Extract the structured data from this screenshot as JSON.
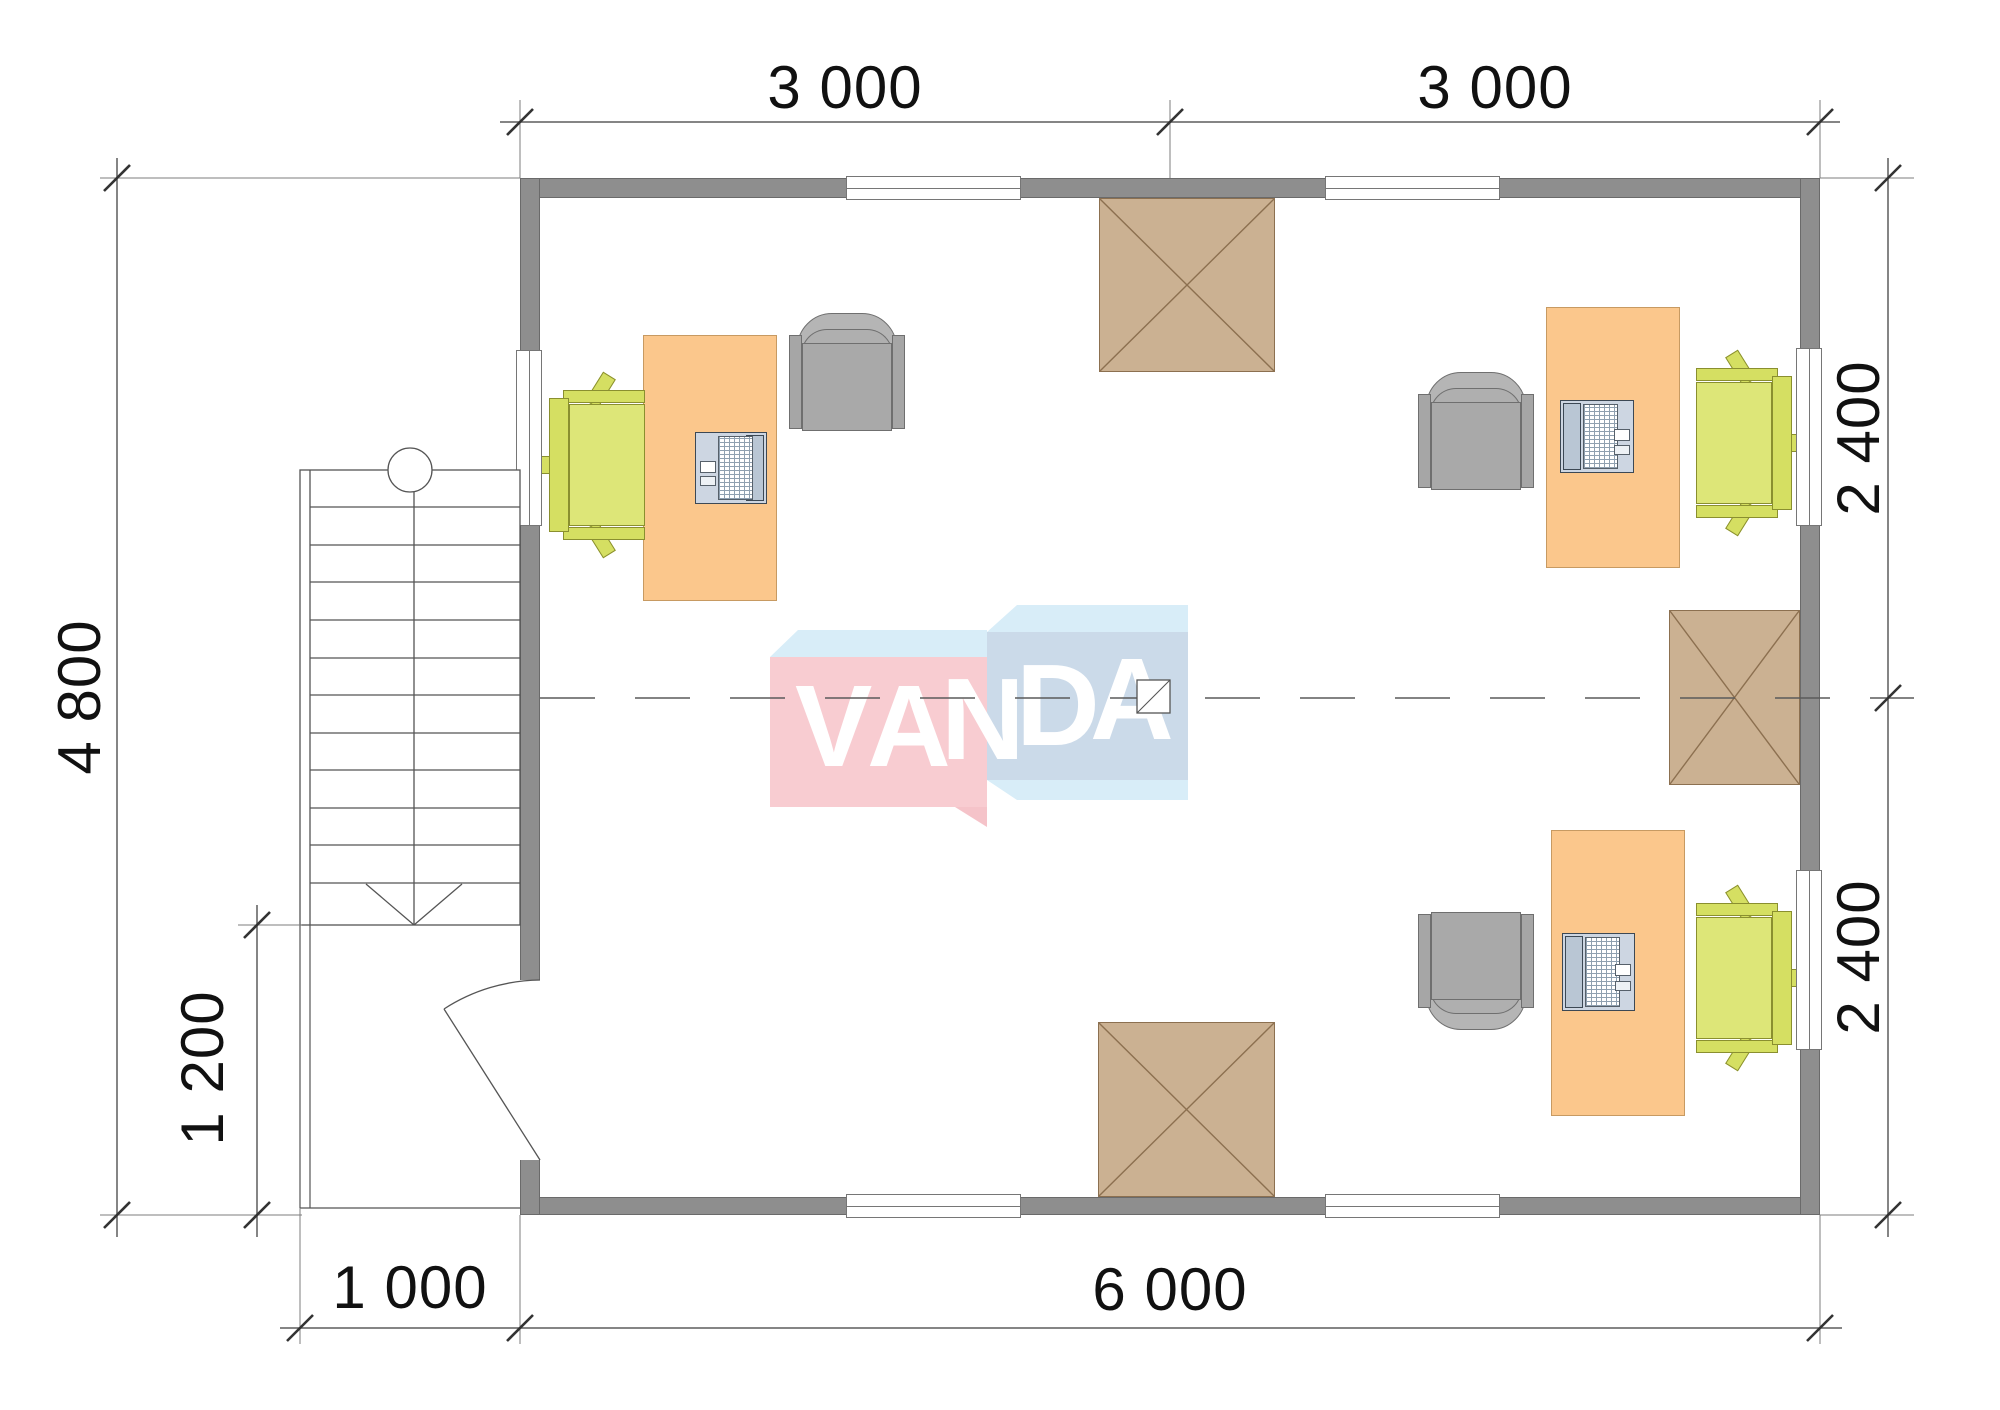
{
  "drawing": {
    "type": "architectural floor plan",
    "logo_letters": [
      "V",
      "A",
      "N",
      "D",
      "A"
    ],
    "dimensions": {
      "top": [
        "3 000",
        "3 000"
      ],
      "bottom": [
        "1 000",
        "6 000"
      ],
      "left": [
        "4 800",
        "1 200"
      ],
      "right": [
        "2 400",
        "2 400"
      ]
    },
    "colors": {
      "wall": "#8E8E8E",
      "desk": "#FBC78C",
      "task_chair_green": "#D5DF62",
      "armchair_gray": "#ABABAB",
      "hatch_brown": "#CBB192",
      "logo_pink": "#F8CCD1",
      "logo_blue": "#CBDAE9",
      "logo_top_face": "#D8EDF8",
      "line": "#555555"
    }
  }
}
